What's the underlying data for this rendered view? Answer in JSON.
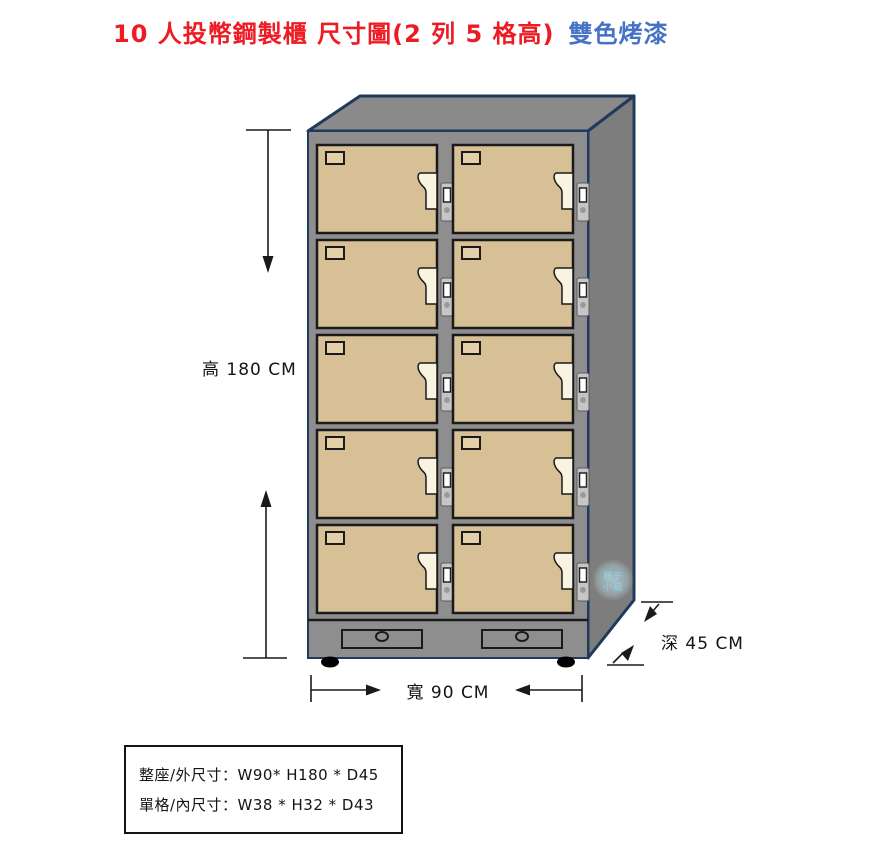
{
  "title": {
    "main": "10 人投幣鋼製櫃  尺寸圖(2 列 5 格高)",
    "suffix": "雙色烤漆"
  },
  "dims": {
    "height": "高 180 CM",
    "width": "寬 90 CM",
    "depth": "深 45 CM"
  },
  "spec": {
    "line1": "整座/外尺寸：W90* H180 * D45",
    "line2": "單格/內尺寸：W38 * H32 * D43"
  },
  "watermark": {
    "line1": "櫃子",
    "line2": "小舖"
  },
  "cabinet": {
    "columns": 2,
    "rows": 5,
    "compartments": 10
  },
  "colors": {
    "title_red": "#ed1c24",
    "title_blue": "#4472c4",
    "door_tan": "#d7bf96",
    "cabinet_gray": "#8e8e8e",
    "outline_navy": "#203a5e",
    "handle_cream": "#f9f4e1"
  }
}
